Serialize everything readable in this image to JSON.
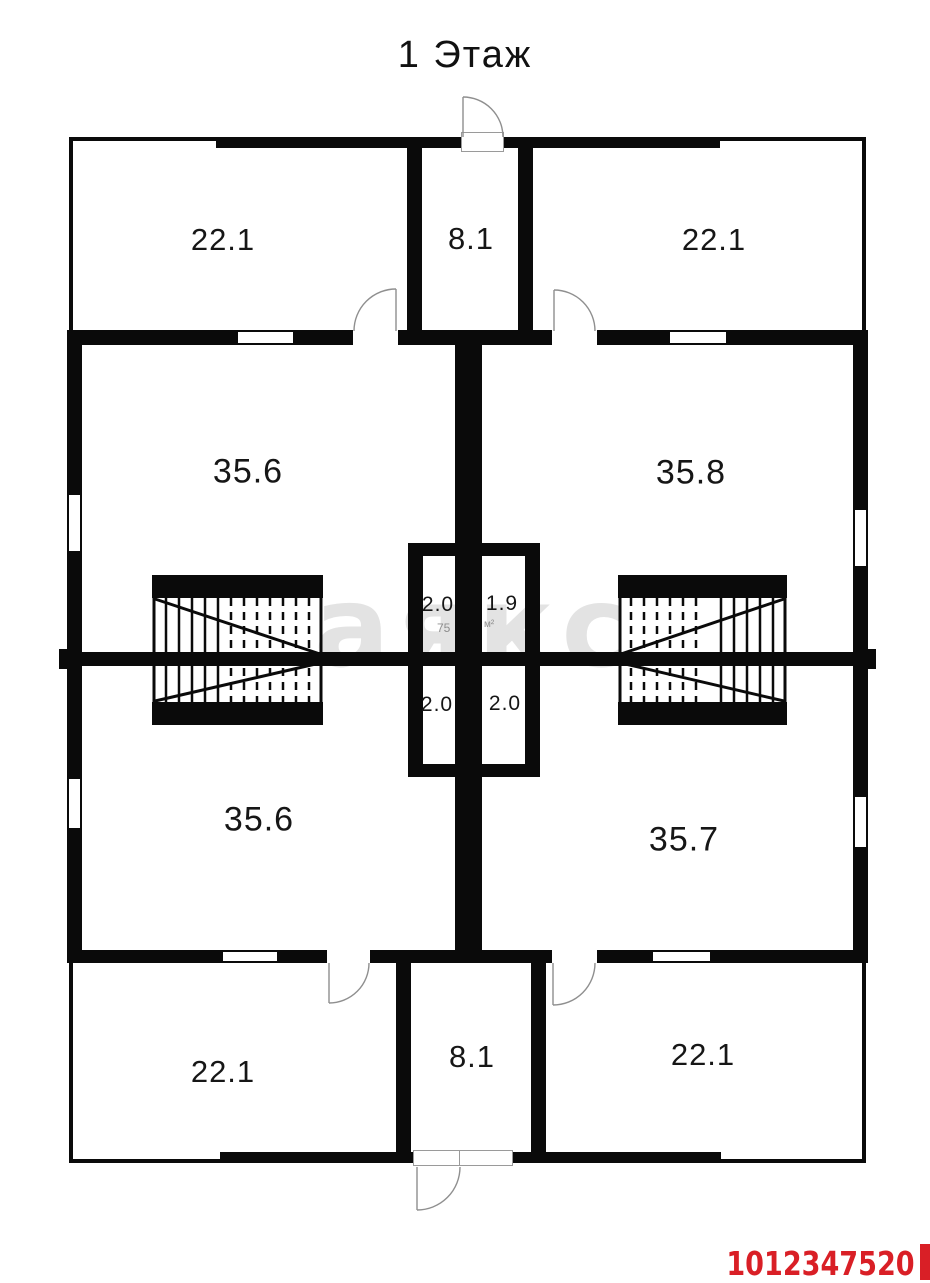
{
  "title": "1 Этаж",
  "watermark_text": "аякс",
  "listing_id": "1012347520",
  "area_note": {
    "left_fragment": "75",
    "right_fragment": "м²"
  },
  "rooms": {
    "top_left": "22.1",
    "top_center": "8.1",
    "top_right": "22.1",
    "middle_upper_left": "35.6",
    "middle_upper_right": "35.8",
    "closet_upper_left": "2.0",
    "closet_upper_right": "1.9",
    "closet_lower_left": "2.0",
    "closet_lower_right": "2.0",
    "middle_lower_left": "35.6",
    "middle_lower_right": "35.7",
    "bottom_left": "22.1",
    "bottom_center": "8.1",
    "bottom_right": "22.1"
  },
  "colors": {
    "wall": "#0a0a0a",
    "listing_id_red": "#d91f26",
    "watermark_gray": "#e3e3e3"
  }
}
